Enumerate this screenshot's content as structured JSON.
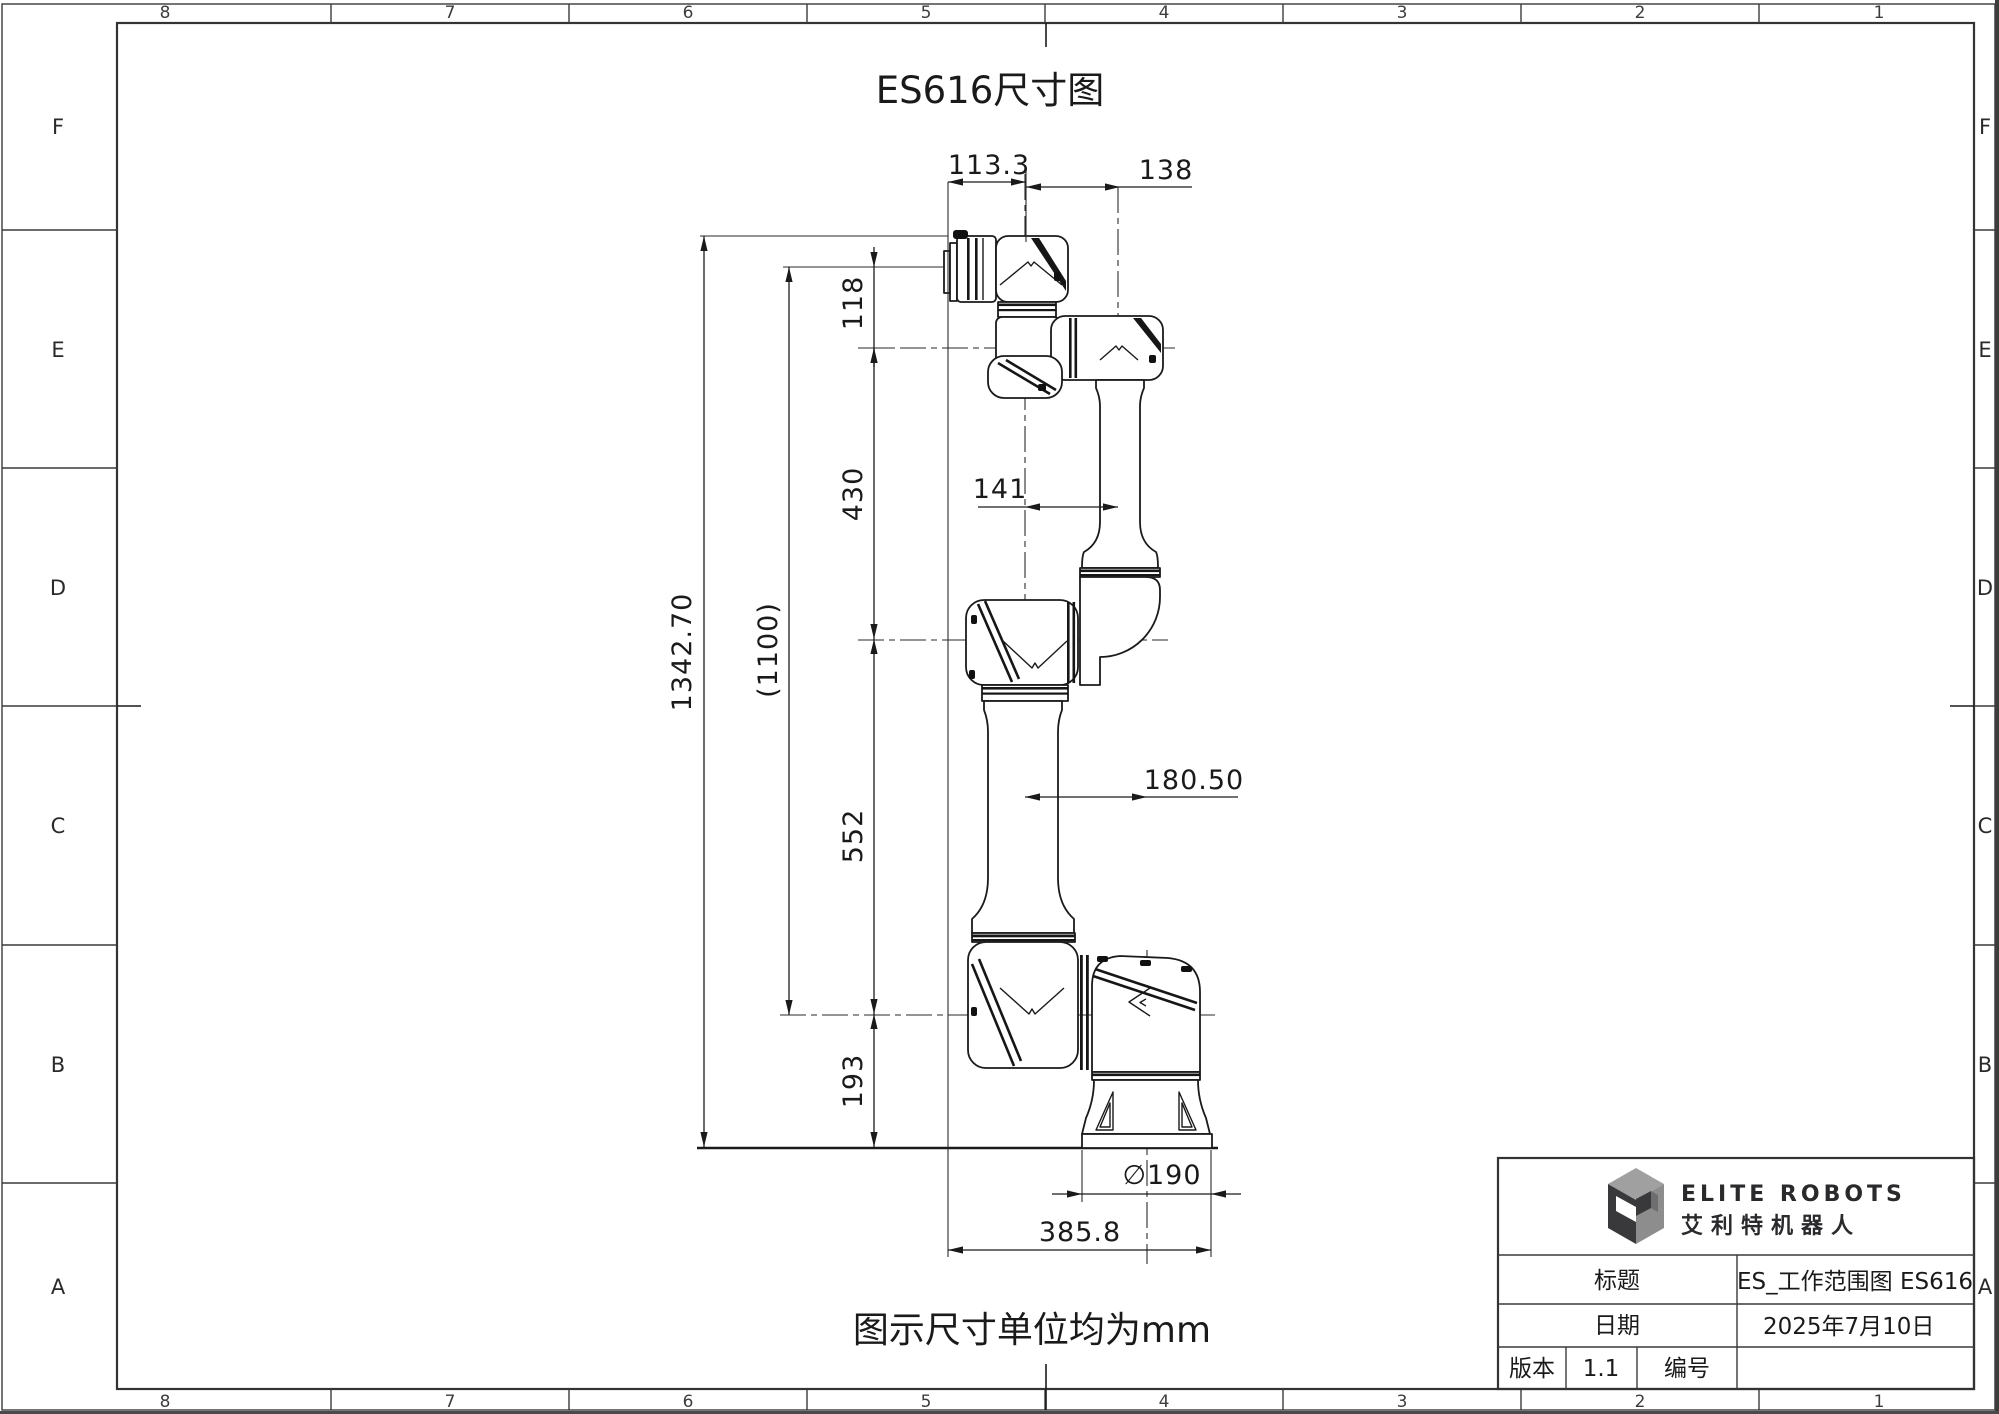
{
  "sheet": {
    "drawing_title": "ES616尺寸图",
    "unit_note": "图示尺寸单位均为mm",
    "zone_cols": {
      "c8": "8",
      "c7": "7",
      "c6": "6",
      "c5": "5",
      "c4": "4",
      "c3": "3",
      "c2": "2",
      "c1": "1"
    },
    "zone_rows": {
      "rF": "F",
      "rE": "E",
      "rD": "D",
      "rC": "C",
      "rB": "B",
      "rA": "A"
    }
  },
  "dims": {
    "flange_offset": "113.3",
    "wrist_offset": "138",
    "wrist_length": "118",
    "forearm_length": "430",
    "total_height": "1342.70",
    "reach_height": "(1100)",
    "elbow_offset": "141",
    "upperarm_length": "552",
    "shoulder_offset": "180.50",
    "base_height": "193",
    "base_diameter": "∅190",
    "footprint_width": "385.8"
  },
  "title_block": {
    "brand_en": "ELITE ROBOTS",
    "brand_cn": "艾利特机器人",
    "title_label": "标题",
    "title_value": "ES_工作范围图 ES616",
    "date_label": "日期",
    "date_value": "2025年7月10日",
    "version_label": "版本",
    "version_value": "1.1",
    "number_label": "编号",
    "number_value": ""
  },
  "colors": {
    "line": "#1a1a1a",
    "frame": "#333333",
    "logo_dark": "#39393b",
    "logo_mid": "#8d8d8d",
    "logo_light": "#a0a0a0"
  }
}
